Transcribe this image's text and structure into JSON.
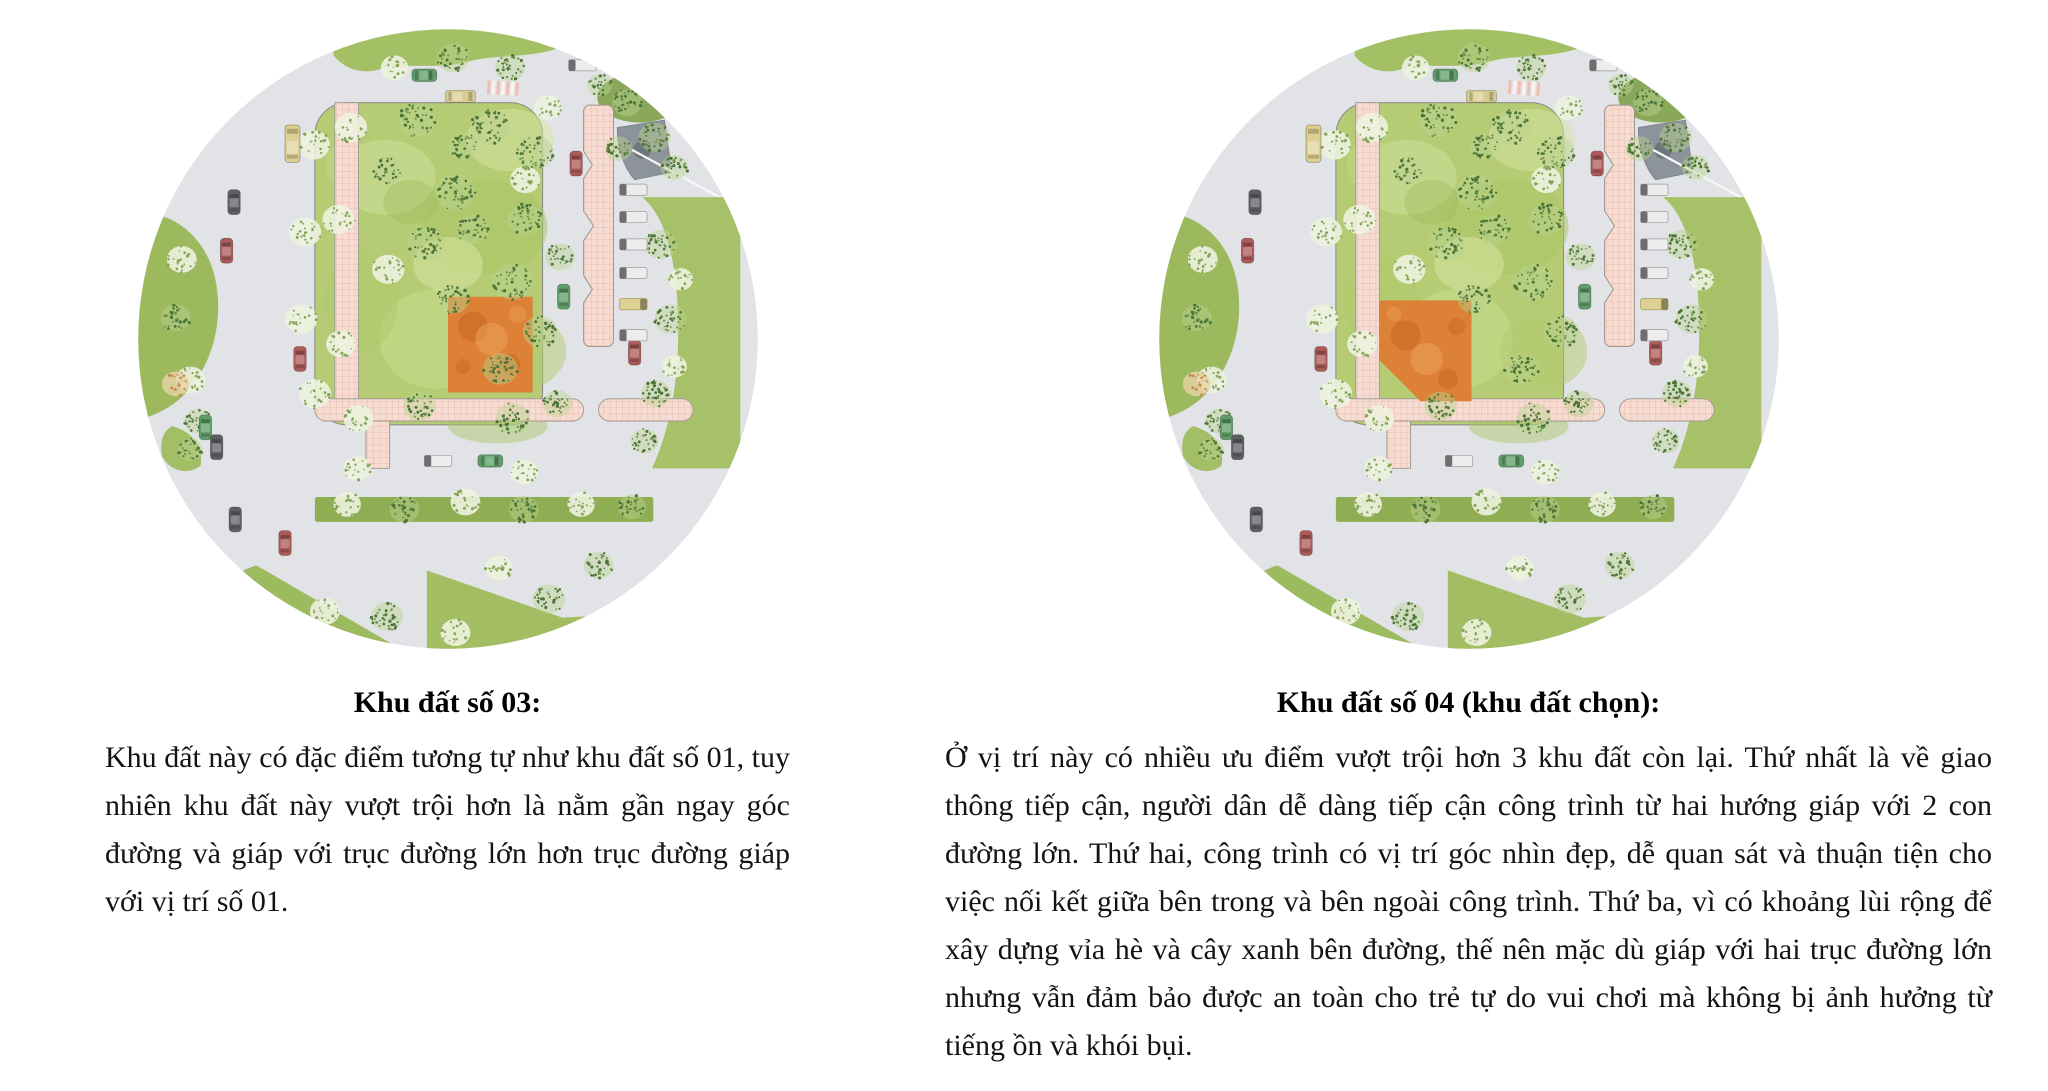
{
  "figures": [
    {
      "id": "plot-03",
      "caption": "Khu đất số 03:",
      "description": "Khu đất này có đặc điểm tương tự như khu đất số 01, tuy nhiên khu đất này vượt trội hơn là nằm gần ngay góc đường và giáp với trục đường lớn hơn trục đường giáp với vị trí số 01."
    },
    {
      "id": "plot-04",
      "caption": "Khu đất số 04 (khu đất chọn):",
      "description": "Ở vị trí này có nhiều ưu điểm vượt trội hơn 3 khu đất còn lại. Thứ nhất là về giao thông tiếp cận, người dân dễ dàng tiếp cận công trình từ hai hướng giáp với 2 con đường lớn. Thứ hai, công trình có vị trí góc nhìn đẹp, dễ quan sát và thuận tiện cho việc nối kết giữa bên trong và bên ngoài công trình. Thứ ba, vì có khoảng lùi rộng để xây dựng vỉa hè và cây xanh bên đường, thế nên mặc dù giáp với hai trục đường lớn nhưng vẫn đảm bảo được an toàn cho trẻ tự do vui chơi mà không bị ảnh hưởng từ tiếng ồn và khói bụi."
    }
  ],
  "map_colors": {
    "road": "#e2e3e6",
    "park": "#b5cc74",
    "path_pink": "#f7dcd3",
    "highlight_orange": "#dd8136",
    "median_green": "#8fad52"
  }
}
